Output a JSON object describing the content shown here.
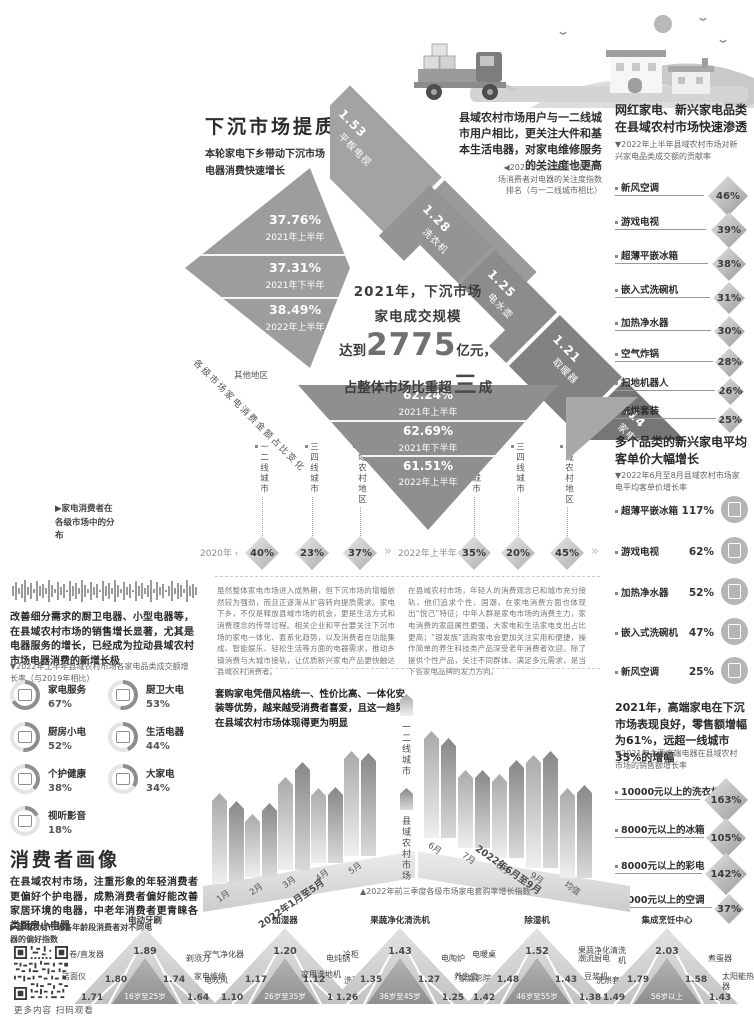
{
  "header": {
    "title": "下沉市场提质扩容",
    "subtitle": "本轮家电下乡带动下沉市场电器消费快速增长"
  },
  "mosaic": {
    "headline_l1": "2021年，下沉市场",
    "headline_l2": "家电成交规模",
    "headline_l3a": "达到",
    "headline_big": "2775",
    "headline_l3b": "亿元，",
    "headline_l4a": "占整体市场比重",
    "headline_l4b": "超",
    "headline_l4c": "三",
    "headline_l4d": "成",
    "other_label": "其他地区",
    "side_label": "各级市场家电消费金额占比变化"
  },
  "focus_note": {
    "text": "县域农村市场用户与一二线城市用户相比，更关注大件和基本生活电器，对家电维修服务的关注度也更高",
    "caption": "◀2022年上半年县域农村市场消费者对电器的关注度指数排名（与一二线城市相比）"
  },
  "distribution": {
    "caption": "▶家电消费者在各级市场中的分布",
    "year1": "2020年 ‹",
    "year2": "2022年上半年 ‹",
    "arrow": "»"
  },
  "right_col": {
    "s1_title": "网红家电、新兴家电品类在县域农村市场快速渗透",
    "s1_caption": "▼2022年上半年县域农村市场对新兴家电品类成交额的贡献率",
    "s2_title": "多个品类的新兴家电平均客单价大幅增长",
    "s2_caption": "▼2022年6月至8月县域农村市场家电平均客单价增长率",
    "s3_text": "2021年，高端家电在下沉市场表现良好，零售额增幅为61%，远超一线城市35%的增幅",
    "s3_caption": "▼2021年主要高端电器在县域农村市场的销售额增长率"
  },
  "left_col": {
    "para": "改善细分需求的厨卫电器、小型电器等，在县域农村市场的销售增长显著，尤其是电器服务的增长，已经成为拉动县域农村市场电器消费的新增长极",
    "caption": "▼2022年上半年县域农村市场各家电品类成交额增长率（与2019年相比）",
    "portrait_title": "消费者画像",
    "portrait_para": "在县域农村市场，注重形象的年轻消费者更偏好个护电器，成熟消费者偏好能改善家居环境的电器，中老年消费者更青睐各类厨房小电器",
    "portrait_caption": "▶县域农村市场各年龄段消费者对不同电器的偏好指数",
    "qr_caption": "更多内容 扫码观看"
  },
  "essays": {
    "left": "虽然整体家电市场进入成熟期，但下沉市场的增幅依然较为强劲，而且正逐渐从扩容转向提质需求。家电下乡，不仅是释放县域市场的机会，更是生活方式和消费理念的传导过程。相关企业和平台要关注下沉市场的家电一体化、套系化趋势，以及消费者在功能集成、智能娱乐、轻松生活等方面的电器需求，推动乡镇消费与大城市接轨，让优质新兴家电产品更快触达县域农村消费者。",
    "right": "在县域农村市场，年轻人的消费观念已和城市充分接轨，他们追求个性、国潮，在家电消费方面也体现出“悦己”特征；中年人群是家电市场的消费主力，家电消费的家庭属性更强，大家电和生活家电支出占比更高；“银发族”选购家电会更加关注实用和便捷，操作简单的养生科技类产品深受老年消费者欢迎。除了提供个性产品，关注不同群体、满足多元需求，是当下各家电品牌的发力方向。"
  },
  "bundle": {
    "headline": "套购家电凭借风格统一、性价比高、一体化安装等优势，越来越受消费者喜爱，且这一趋势在县域农村市场体现得更为明显",
    "caption": "▲2022年前三季度各级市场家电套购率增长指数"
  },
  "chart_data": [
    {
      "id": "tier_share",
      "type": "bar",
      "title": "各级市场家电消费金额占比变化",
      "unit": "%",
      "categories": [
        "2021年上半年",
        "2021年下半年",
        "2022年上半年"
      ],
      "series": [
        {
          "name": "一二线城市",
          "values": [
            37.76,
            37.31,
            38.49
          ],
          "display": [
            "37.76%",
            "37.31%",
            "38.49%"
          ]
        },
        {
          "name": "其他地区",
          "values": [
            62.24,
            62.69,
            61.51
          ],
          "display": [
            "62.24%",
            "62.69%",
            "61.51%"
          ]
        }
      ]
    },
    {
      "id": "attention_index",
      "type": "bar",
      "title": "2022年上半年县域农村市场消费者对电器的关注度指数排名（与一二线城市相比）",
      "categories": [
        "平板电视",
        "电热水器",
        "洗衣机",
        "电水壶",
        "取暖器",
        "家电维修"
      ],
      "values": [
        1.53,
        1.45,
        1.28,
        1.25,
        1.21,
        1.14
      ],
      "display": [
        "1.53",
        "1.45",
        "1.28",
        "1.25",
        "1.21",
        "1.14"
      ]
    },
    {
      "id": "consumer_distribution",
      "type": "pie",
      "title": "家电消费者在各级市场中的分布",
      "groups": [
        {
          "year": "2020年",
          "items": [
            {
              "label": "一二线城市",
              "value": 40,
              "text": "40%"
            },
            {
              "label": "三四线城市",
              "value": 23,
              "text": "23%"
            },
            {
              "label": "县域农村地区",
              "value": 37,
              "text": "37%"
            }
          ]
        },
        {
          "year": "2022年上半年",
          "items": [
            {
              "label": "一二线城市",
              "value": 35,
              "text": "35%"
            },
            {
              "label": "三四线城市",
              "value": 20,
              "text": "20%"
            },
            {
              "label": "县域农村地区",
              "value": 45,
              "text": "45%"
            }
          ]
        }
      ]
    },
    {
      "id": "emerging_contribution",
      "type": "bar",
      "title": "2022年上半年县域农村市场对新兴家电品类成交额的贡献率",
      "items": [
        {
          "label": "新风空调",
          "value": 46,
          "text": "46%"
        },
        {
          "label": "游戏电视",
          "value": 39,
          "text": "39%"
        },
        {
          "label": "超薄平嵌冰箱",
          "value": 38,
          "text": "38%"
        },
        {
          "label": "嵌入式洗碗机",
          "value": 31,
          "text": "31%"
        },
        {
          "label": "加热净水器",
          "value": 30,
          "text": "30%"
        },
        {
          "label": "空气炸锅",
          "value": 28,
          "text": "28%"
        },
        {
          "label": "扫地机器人",
          "value": 26,
          "text": "26%"
        },
        {
          "label": "洗烘套装",
          "value": 25,
          "text": "25%"
        }
      ]
    },
    {
      "id": "aov_growth",
      "type": "bar",
      "title": "2022年6月至8月县域农村市场家电平均客单价增长率",
      "items": [
        {
          "label": "超薄平嵌冰箱",
          "value": 117,
          "text": "117%",
          "icon": "fridge-icon"
        },
        {
          "label": "游戏电视",
          "value": 62,
          "text": "62%",
          "icon": "game-tv-icon"
        },
        {
          "label": "加热净水器",
          "value": 52,
          "text": "52%",
          "icon": "water-heater-icon"
        },
        {
          "label": "嵌入式洗碗机",
          "value": 47,
          "text": "47%",
          "icon": "dishwasher-icon"
        },
        {
          "label": "新风空调",
          "value": 25,
          "text": "25%",
          "icon": "air-conditioner-icon"
        }
      ]
    },
    {
      "id": "category_growth",
      "type": "bar",
      "title": "2022年上半年县域农村市场各家电品类成交额增长率（与2019年相比）",
      "items": [
        {
          "label": "家电服务",
          "value": 67,
          "text": "67%",
          "icon": "service-tools-icon"
        },
        {
          "label": "厨卫大电",
          "value": 53,
          "text": "53%",
          "icon": "kitchen-bath-icon"
        },
        {
          "label": "厨房小电",
          "value": 52,
          "text": "52%",
          "icon": "kitchen-small-icon"
        },
        {
          "label": "生活电器",
          "value": 44,
          "text": "44%",
          "icon": "living-appliance-icon"
        },
        {
          "label": "个护健康",
          "value": 38,
          "text": "38%",
          "icon": "personal-care-icon"
        },
        {
          "label": "大家电",
          "value": 34,
          "text": "34%",
          "icon": "major-appliance-icon"
        },
        {
          "label": "视听影音",
          "value": 18,
          "text": "18%",
          "icon": "audio-video-icon"
        }
      ]
    },
    {
      "id": "highend_growth",
      "type": "bar",
      "title": "2021年主要高端电器在县域农村市场的销售额增长率",
      "items": [
        {
          "label": "10000元以上的洗衣机",
          "value": 163,
          "text": "163%"
        },
        {
          "label": "8000元以上的冰箱",
          "value": 105,
          "text": "105%"
        },
        {
          "label": "8000元以上的彩电",
          "value": 142,
          "text": "142%"
        },
        {
          "label": "8000元以上的空调",
          "value": 37,
          "text": "37%"
        }
      ]
    },
    {
      "id": "bundle_index",
      "type": "bar",
      "title": "2022年前三季度各级市场家电套购率增长指数",
      "legend": [
        "一二线城市",
        "县域农村市场"
      ],
      "groups": [
        {
          "axis": "2022年1月至5月",
          "categories": [
            "1月",
            "2月",
            "3月",
            "4月",
            "5月"
          ],
          "series": [
            {
              "name": "一二线城市",
              "values": [
                1.79,
                1.55,
                1.81,
                1.65,
                1.91
              ],
              "display": [
                "1.79",
                "1.55",
                "1.81",
                "1.65",
                "1.91"
              ]
            },
            {
              "name": "县域农村市场",
              "values": [
                1.72,
                1.64,
                1.94,
                1.66,
                1.9
              ],
              "display": [
                "1.72",
                "1.64",
                "1.94",
                "1.66",
                "1.90"
              ]
            }
          ]
        },
        {
          "axis": "2022年6月至9月",
          "categories": [
            "6月",
            "7月",
            "8月",
            "9月",
            "均值"
          ],
          "series": [
            {
              "name": "一二线城市",
              "values": [
                1.93,
                1.68,
                1.73,
                1.98,
                1.78
              ],
              "display": [
                "1.93",
                "1.68",
                "1.73",
                "1.98",
                "1.78"
              ]
            },
            {
              "name": "县域农村市场",
              "values": [
                1.87,
                1.68,
                1.85,
                2.02,
                1.81
              ],
              "display": [
                "1.87",
                "1.68",
                "1.85",
                "2.02",
                "1.81"
              ]
            }
          ]
        }
      ]
    },
    {
      "id": "age_preference",
      "type": "pyramid",
      "title": "县域农村市场各年龄段消费者对不同电器的偏好指数",
      "groups": [
        {
          "age": "16岁至25岁",
          "items": [
            {
              "pos": "top",
              "label": "电动牙刷",
              "value": 1.89,
              "text": "1.89"
            },
            {
              "pos": "left",
              "label": "卷/直发器",
              "value": 1.8,
              "text": "1.80"
            },
            {
              "pos": "right",
              "label": "剃须刀",
              "value": 1.74,
              "text": "1.74"
            },
            {
              "pos": "bl",
              "label": "洁面仪",
              "value": 1.71,
              "text": "1.71"
            },
            {
              "pos": "br",
              "label": "电吹风",
              "value": 1.64,
              "text": "1.64"
            }
          ]
        },
        {
          "age": "26岁至35岁",
          "items": [
            {
              "pos": "top",
              "label": "加湿器",
              "value": 1.2,
              "text": "1.20"
            },
            {
              "pos": "left",
              "label": "空气净化器",
              "value": 1.17,
              "text": "1.17"
            },
            {
              "pos": "right",
              "label": "电炖锅",
              "value": 1.12,
              "text": "1.12"
            },
            {
              "pos": "bl",
              "label": "家电维修",
              "value": 1.1,
              "text": "1.10"
            },
            {
              "pos": "br",
              "label": "洗碗机",
              "value": 1.1,
              "text": "1.10"
            }
          ]
        },
        {
          "age": "36岁至45岁",
          "items": [
            {
              "pos": "top",
              "label": "果蔬净化清洗机",
              "value": 1.43,
              "text": "1.43"
            },
            {
              "pos": "left",
              "label": "冷柜",
              "value": 1.35,
              "text": "1.35"
            },
            {
              "pos": "right",
              "label": "电陶炉",
              "value": 1.27,
              "text": "1.27"
            },
            {
              "pos": "bl",
              "label": "家用洗地机",
              "value": 1.26,
              "text": "1.26"
            },
            {
              "pos": "br",
              "label": "家庭影院",
              "value": 1.25,
              "text": "1.25"
            }
          ]
        },
        {
          "age": "46岁至55岁",
          "items": [
            {
              "pos": "top",
              "label": "除湿机",
              "value": 1.52,
              "text": "1.52"
            },
            {
              "pos": "left",
              "label": "电暖桌",
              "value": 1.48,
              "text": "1.48"
            },
            {
              "pos": "right",
              "label": "潮流厨电",
              "value": 1.43,
              "text": "1.43"
            },
            {
              "pos": "bl",
              "label": "养生壶",
              "value": 1.42,
              "text": "1.42"
            },
            {
              "pos": "br",
              "label": "洗烘套装",
              "value": 1.38,
              "text": "1.38"
            }
          ]
        },
        {
          "age": "56岁以上",
          "items": [
            {
              "pos": "top",
              "label": "集成烹饪中心",
              "value": 2.03,
              "text": "2.03"
            },
            {
              "pos": "left",
              "label": "果蔬净化清洗机",
              "value": 1.79,
              "text": "1.79"
            },
            {
              "pos": "right",
              "label": "煮蛋器",
              "value": 1.58,
              "text": "1.58"
            },
            {
              "pos": "bl",
              "label": "豆浆机",
              "value": 1.49,
              "text": "1.49"
            },
            {
              "pos": "br",
              "label": "太阳能热水器",
              "value": 1.43,
              "text": "1.43"
            }
          ]
        }
      ]
    }
  ]
}
